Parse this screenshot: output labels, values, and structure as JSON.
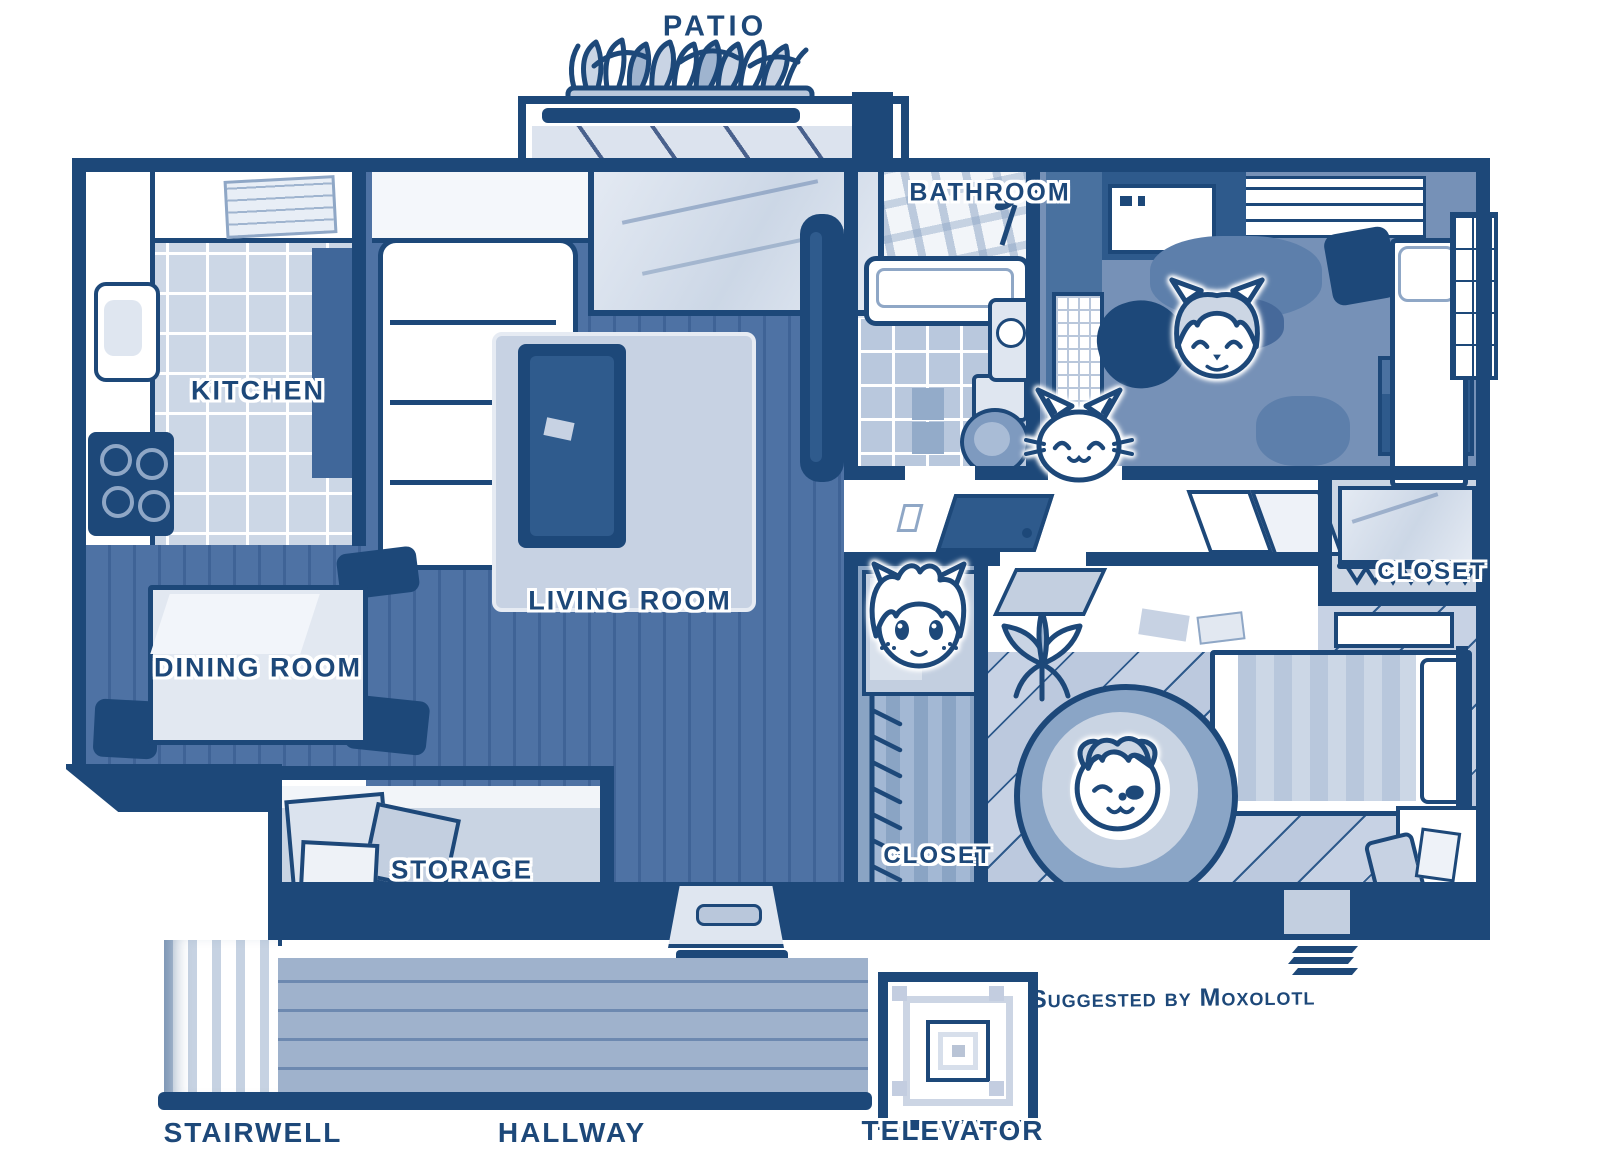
{
  "labels": {
    "patio": "PATIO",
    "kitchen": "KITCHEN",
    "living_room": "LIVING ROOM",
    "dining_room": "DINING ROOM",
    "bathroom": "BATHROOM",
    "closet_upper": "CLOSET",
    "closet_lower": "CLOSET",
    "storage": "STORAGE",
    "stairwell": "STAIRWELL",
    "hallway": "HALLWAY",
    "televator": "TELEVATOR"
  },
  "credit": "Suggested by Moxolotl",
  "characters": [
    {
      "icon": "catgirl-sleeping-face-icon"
    },
    {
      "icon": "kitten-face-icon"
    },
    {
      "icon": "catgirl-awake-face-icon"
    },
    {
      "icon": "redpanda-winking-face-icon"
    }
  ],
  "colors": {
    "ink": "#1d4879",
    "living_floor": "#4c70a2",
    "kitchen_tile": "#ccd7e6",
    "bath_tile": "#b9c8dd",
    "bedroom1_floor": "#7691b7",
    "bedroom2_floor": "#c7d2e4",
    "hallway_floor": "#9fb2cc",
    "accent_light": "#c9d4e4",
    "paper": "#ffffff"
  }
}
